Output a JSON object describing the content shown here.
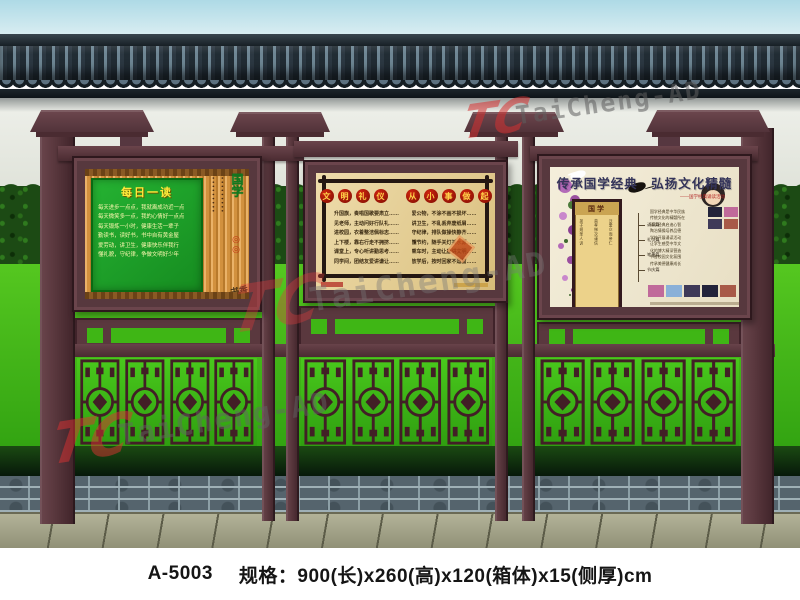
{
  "caption": {
    "model": "A-5003",
    "spec": "规格：900(长)x260(高)x120(箱体)x15(侧厚)cm"
  },
  "watermark": {
    "logo": "TC",
    "brand": "TaiCheng-AD"
  },
  "panels": {
    "left": {
      "title": "每日一读",
      "lines": [
        "每天进步一点点，我就离成功近一点",
        "每天微笑多一点，我的心情好一点点",
        "每天锻炼一小时，健康生活一辈子",
        "勤读书，读好书，书中自有黄金屋",
        "爱劳动，讲卫生，健康快乐伴我行",
        "懂礼貌，守纪律，争做文明好少年"
      ],
      "dots": "•••••••••",
      "side_title": "国学",
      "side_seals": "◎◎",
      "side_script": "书香"
    },
    "middle": {
      "title1": [
        "文",
        "明",
        "礼",
        "仪"
      ],
      "title2": [
        "从",
        "小",
        "事",
        "做",
        "起"
      ],
      "columns": [
        [
          "升国旗，奏唱国歌要肃立……",
          "见老师，主动问好行队礼……",
          "进校园，衣着整洁佩标志……",
          "上下楼，靠右行走不拥挤……",
          "课堂上，专心听讲勤思考……",
          "同学间，团结友爱讲谦让……"
        ],
        [
          "爱公物，不涂不画不损坏……",
          "讲卫生，不乱丢弃废纸屑……",
          "守纪律，排队做操快静齐……",
          "懂节约，随手关灯关水源……",
          "乘车时，主动让座讲文明……",
          "放学后，按时回家不逗留……"
        ]
      ]
    },
    "right": {
      "title": "传承国学经典　弘扬文化精髓",
      "subtitle": "——国学经典诵读活动",
      "scroll_header": "国学",
      "scroll_cols": [
        "弟子规圣人训",
        "首孝悌次谨信",
        "泛爱众而亲仁"
      ],
      "diagram": [
        "诵读篇",
        "礼仪篇",
        "笔墨篇",
        "节庆篇"
      ],
      "paragraph": [
        "国学经典是中华民族",
        "传统文化的精髓所在",
        "诵读经典启迪心智",
        "陶冶情操培养品德",
        "学校开展诵读活动",
        "让学生感受中华文",
        "化的博大精深营造",
        "书香校园文化氛围",
        "传承美德健康成长"
      ]
    }
  },
  "colors": {
    "kiosk_maroon": "#5a383e",
    "grass_green": "#3fb615",
    "panel_green": "#1fa32c",
    "bamboo_tan": "#d2913e",
    "parchment": "#e9d7a2",
    "cream": "#efe8d6",
    "seal_red": "#c11b0a",
    "watermark_red": "#e03a3a"
  }
}
